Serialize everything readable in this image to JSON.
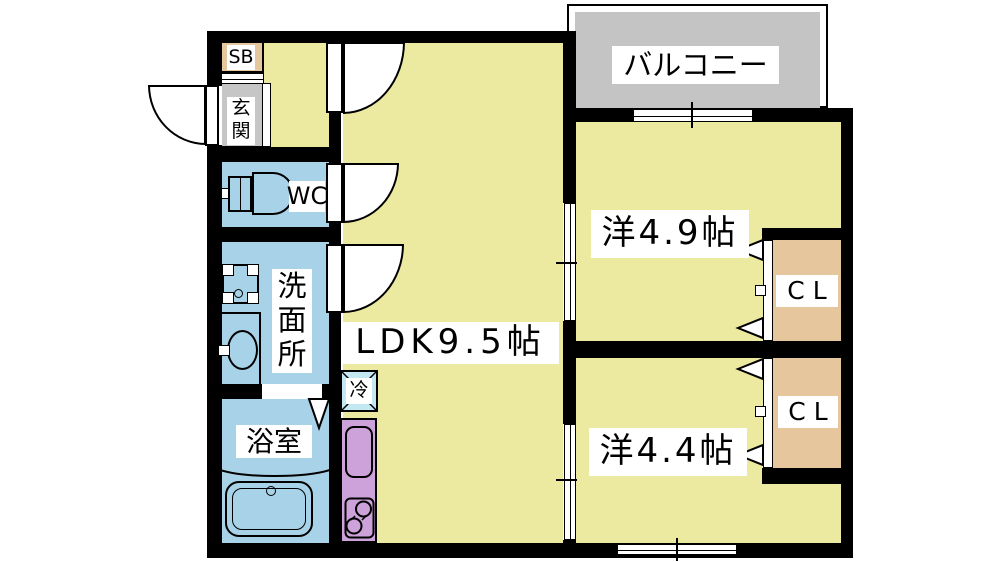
{
  "colors": {
    "wall": "#000000",
    "room_yellow": "#ece9a0",
    "water_blue": "#a8d2e8",
    "entry_gray": "#c6c6c6",
    "balcony_gray": "#c4c4c4",
    "closet_tan": "#e6c69c",
    "kitchen_purple": "#cda2da",
    "fridge_cyan": "#c3e8f2"
  },
  "labels": {
    "balcony": "バルコニー",
    "entrance": "玄関",
    "shoe_box": "SB",
    "toilet": "WC",
    "washroom": "洗面所",
    "bathroom": "浴室",
    "ldk": "LDK9.5帖",
    "western_room_1": "洋4.9帖",
    "western_room_2": "洋4.4帖",
    "closet_1": "CL",
    "closet_2": "CL",
    "refrigerator": "冷"
  }
}
